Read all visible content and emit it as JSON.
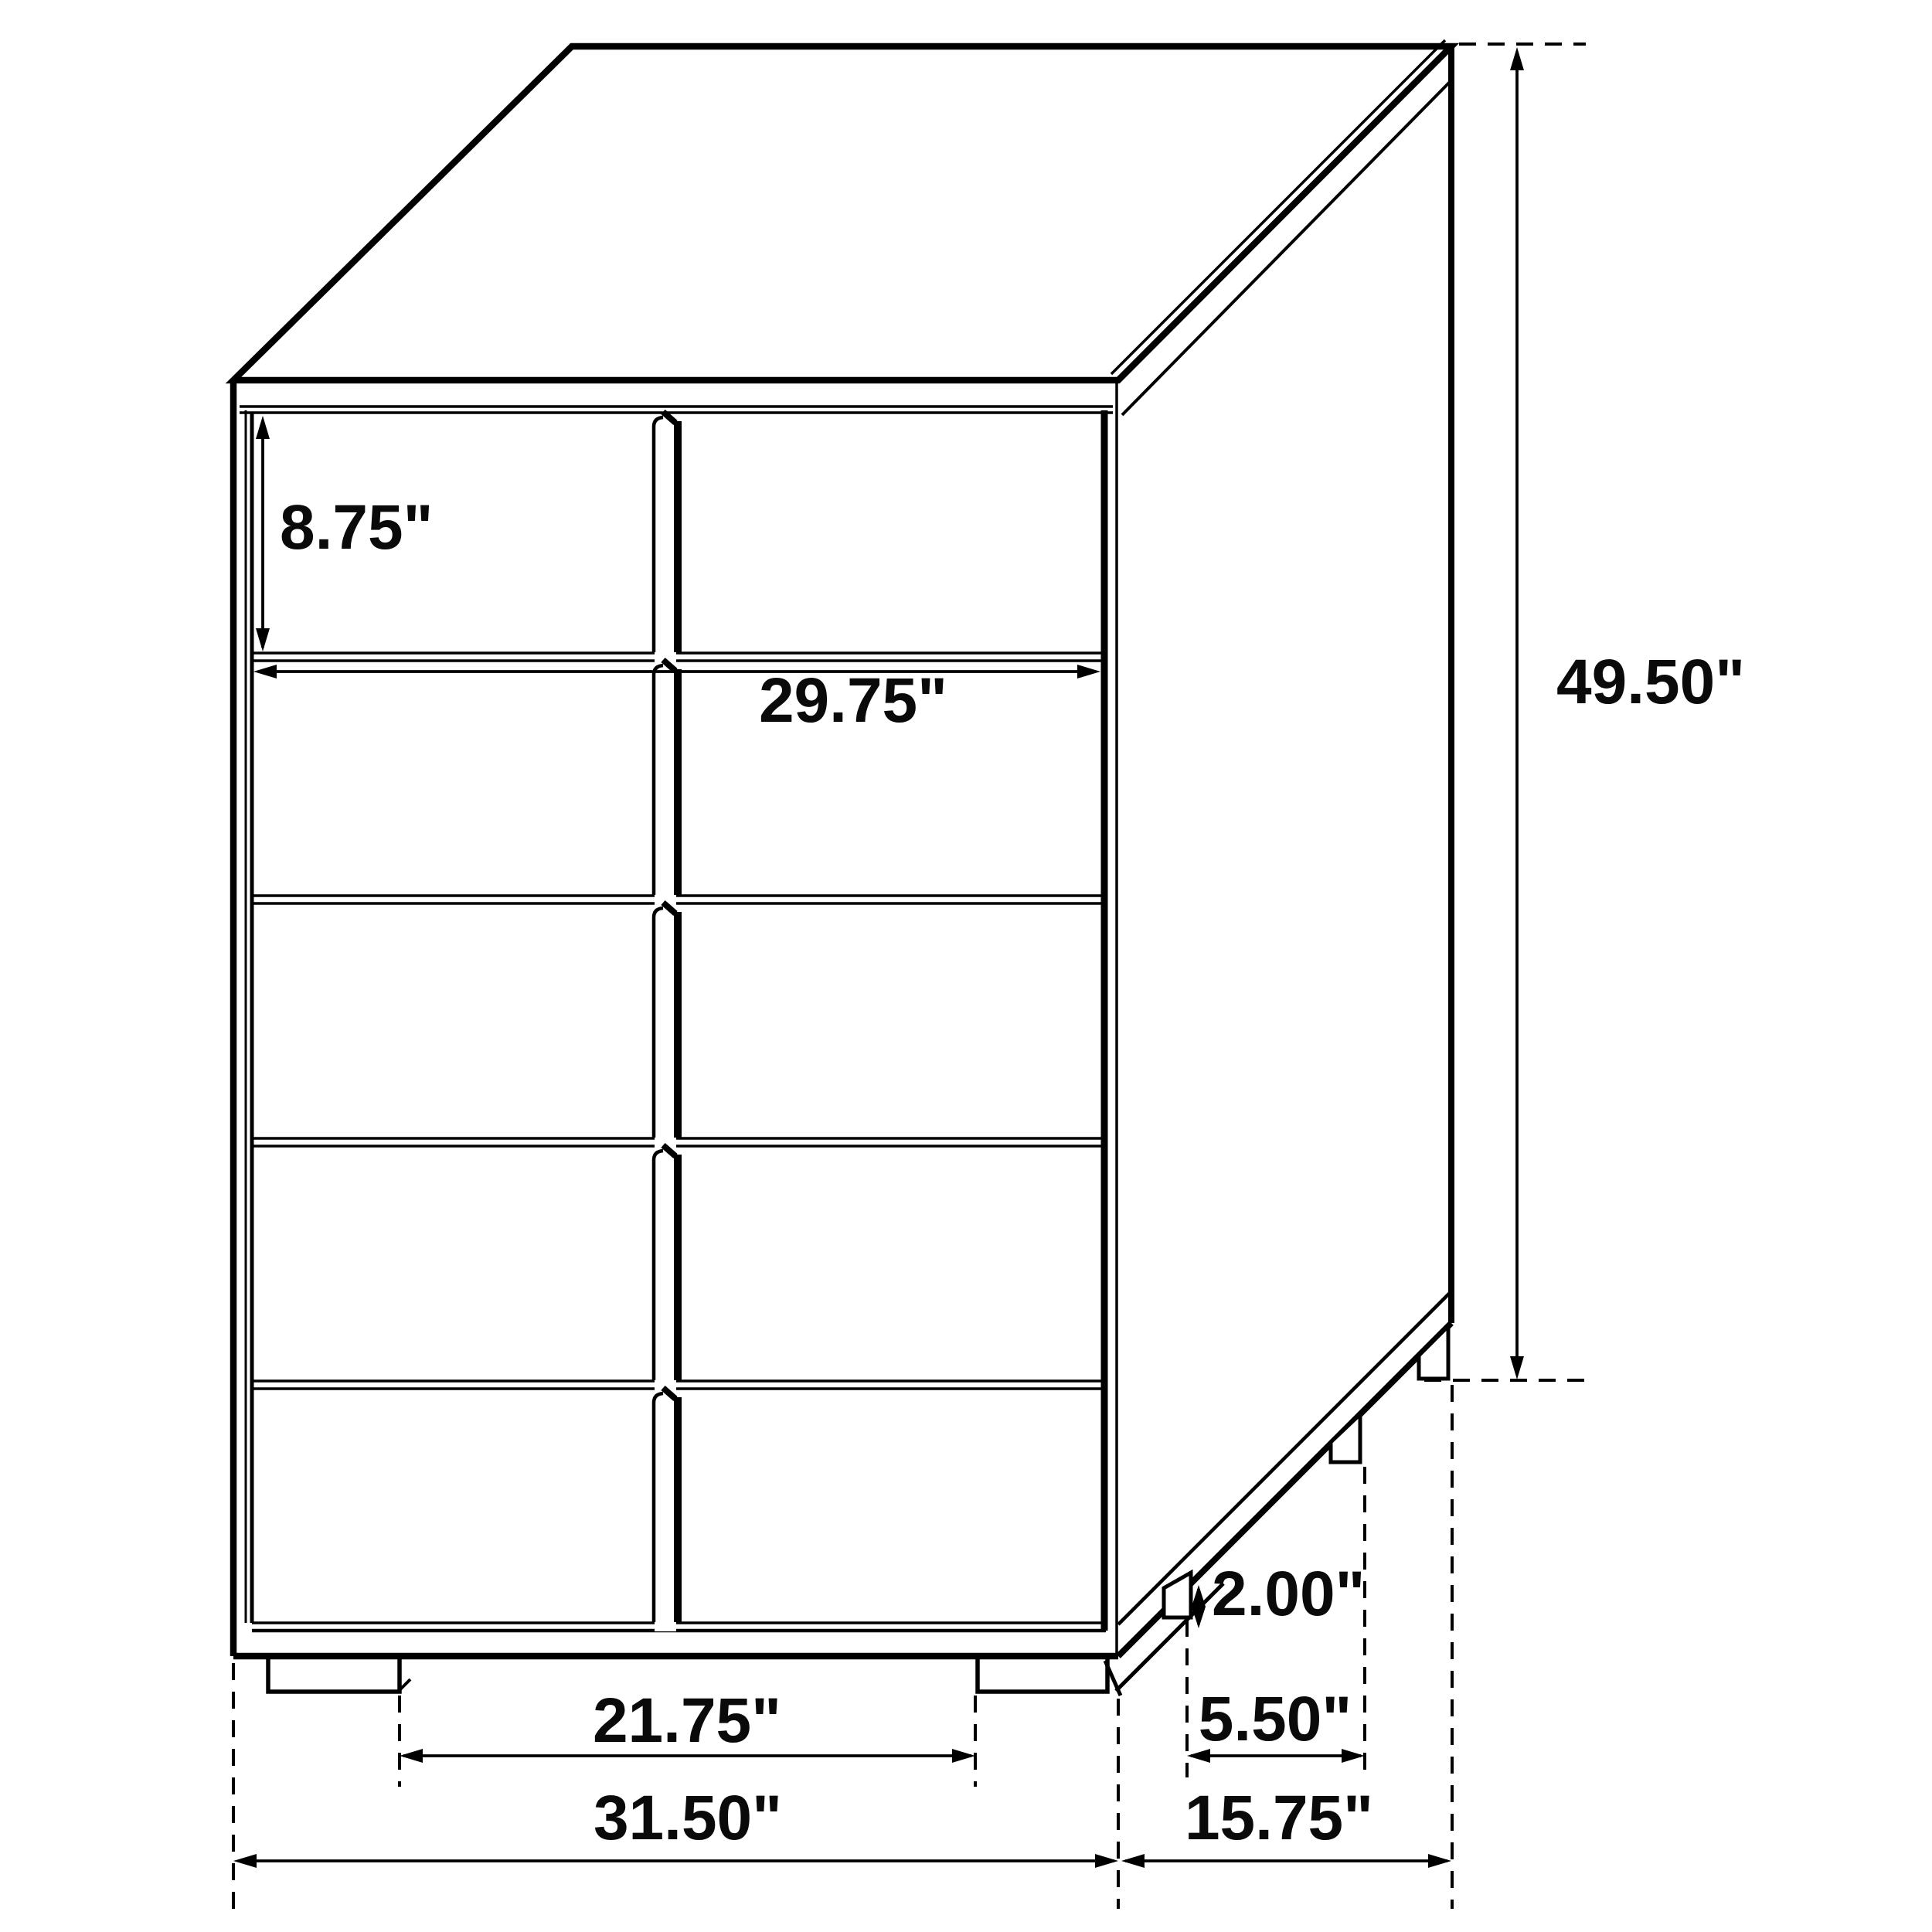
{
  "dimensions": {
    "drawer_height": "8.75\"",
    "drawer_width": "29.75\"",
    "overall_height": "49.50\"",
    "leg_height": "2.00\"",
    "side_leg_spacing": "5.50\"",
    "front_leg_spacing": "21.75\"",
    "overall_width": "31.50\"",
    "overall_depth": "15.75\""
  },
  "colors": {
    "line": "#000000",
    "background": "#ffffff"
  }
}
